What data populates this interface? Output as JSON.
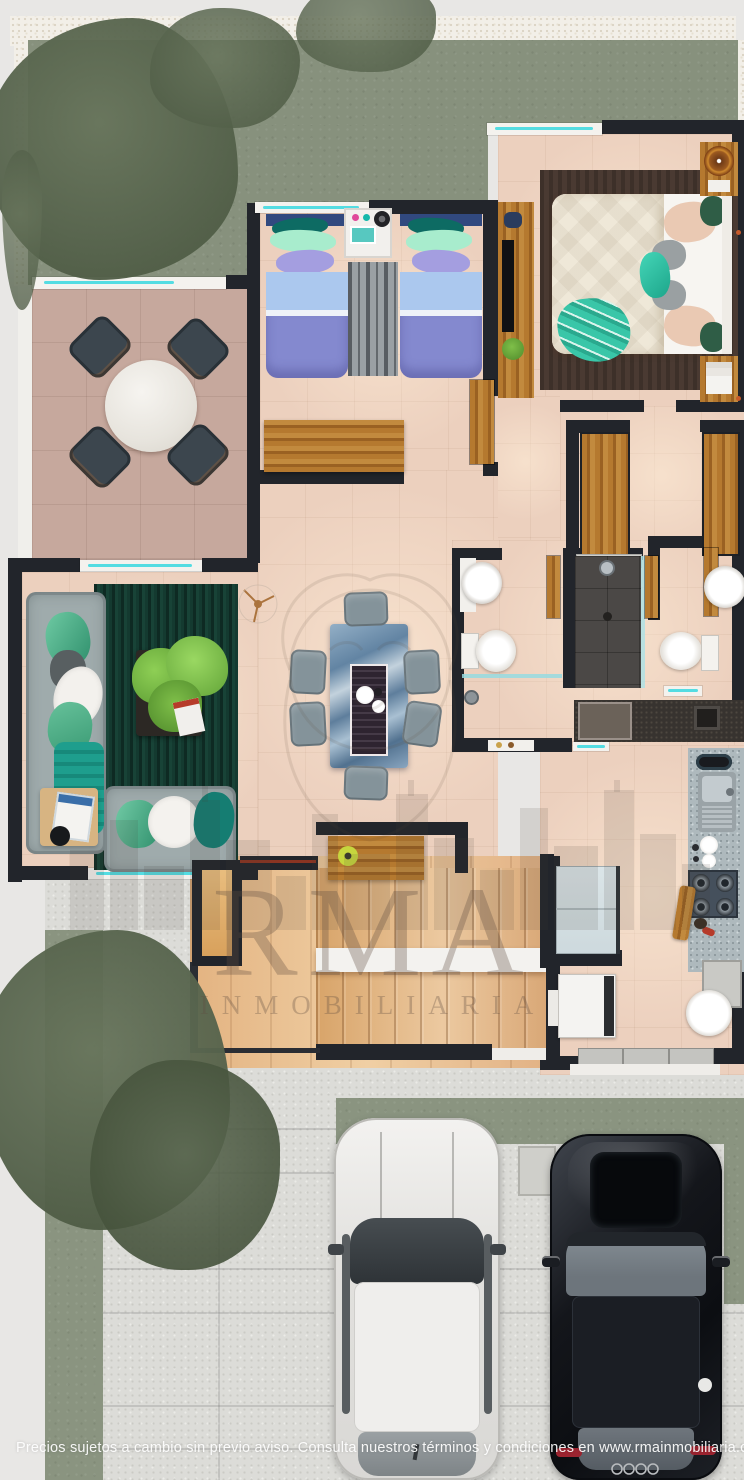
{
  "brand": {
    "name": "RMA",
    "subtitle": "INMOBILIARIA"
  },
  "caption": "Precios sujetos a cambio sin previo aviso. Consulta nuestros términos y condiciones en www.rmainmobiliaria.com.mx",
  "colors": {
    "wall": "#22252b",
    "floor_tile": "#ecd0be",
    "terrace_tile": "#c6a89d",
    "lawn": "#87917d",
    "gravel": "#f2efe8",
    "concrete": "#dcdcd8",
    "grass_strip": "#8a9480",
    "rug_living": "#143a30",
    "rug_master": "#4a3a32",
    "rug_kids": "#9aa0a4",
    "sofa_gray": "#9fabac",
    "duvet_kids": "#8489cf",
    "sheet_kids": "#abc8ee",
    "pillow_mint": "#a8eccd",
    "pillow_teal": "#0d6b63",
    "pillow_lavender": "#a49ee0",
    "duvet_master": "#efe8d8",
    "pillow_blush": "#eac9b3",
    "throw_teal": "#39c6a8",
    "dining_marble": "#7b97b3",
    "chair_gray": "#84939a",
    "shower_dark": "#4b4846",
    "granite": "#aeb9bd",
    "counter_dark": "#37332f",
    "glass_teal": "#54dce2",
    "wood": "#ab7031",
    "car_white": "#eeedeb",
    "car_black": "#15171c",
    "accent_red": "#c75b2a",
    "candle_lime": "#c6d63e",
    "watermark": "#5f4c41"
  }
}
